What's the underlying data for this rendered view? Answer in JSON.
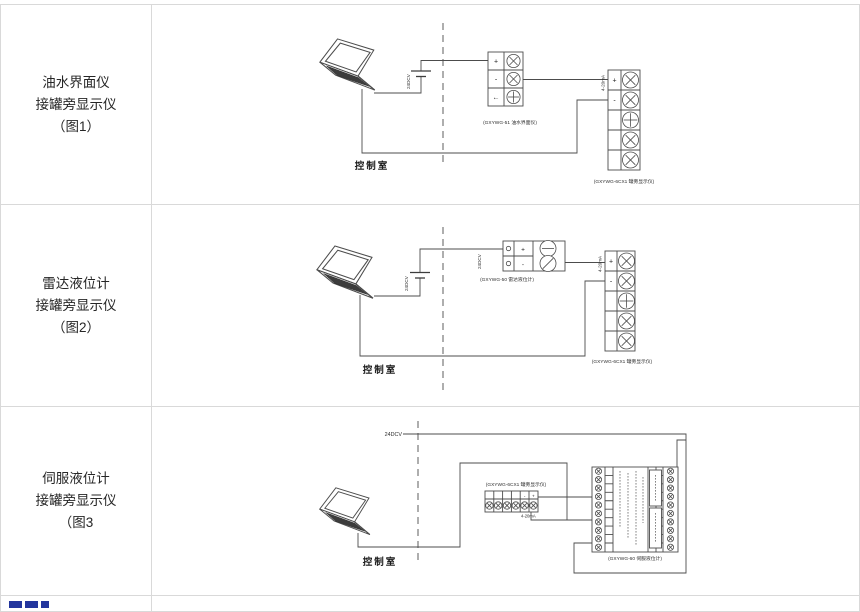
{
  "table": {
    "rows": [
      {
        "label_lines": [
          "油水界面仪",
          "接罐旁显示仪",
          "（图1）"
        ],
        "control_room_label": "控制室",
        "battery_label": "24DCV",
        "signal_label": "4-20mA",
        "transmitter": {
          "label": "(GXYWG-51 油水界面仪)",
          "terminals": [
            "+",
            "-",
            "←"
          ]
        },
        "display": {
          "label": "(GXYWG-6CX1 罐旁显示仪)",
          "terminals": [
            "+",
            "-"
          ]
        }
      },
      {
        "label_lines": [
          "雷达液位计",
          "接罐旁显示仪",
          "（图2）"
        ],
        "control_room_label": "控制室",
        "battery_label": "24DCV",
        "power_label": "24DCV",
        "signal_label": "4-20mA",
        "transmitter": {
          "label": "(GXYWG-50 雷达液位计)",
          "terminals": [
            "+",
            "-"
          ]
        },
        "display": {
          "label": "(GXYWG-6CX1 罐旁显示仪)",
          "terminals": [
            "+",
            "-"
          ]
        }
      },
      {
        "label_lines": [
          "伺服液位计",
          "接罐旁显示仪",
          "（图3"
        ],
        "control_room_label": "控制室",
        "power_label": "24DCV",
        "signal_label": "4-20mA",
        "display": {
          "label": "(GXYWG-6CX1 罐旁显示仪)",
          "terminals": [
            "-",
            "+"
          ]
        },
        "servo": {
          "label": "(GXYWG-60 伺服液位计)"
        }
      }
    ]
  }
}
